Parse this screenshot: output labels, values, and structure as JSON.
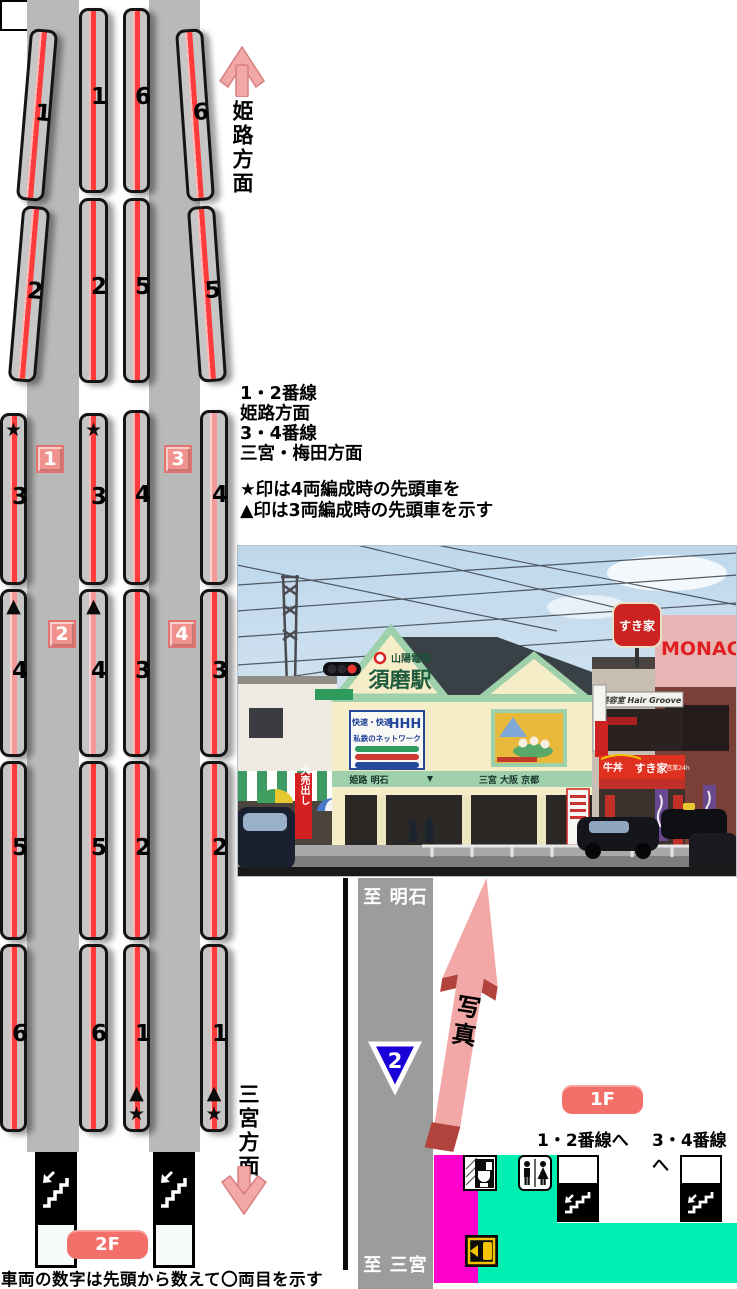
{
  "diagram": {
    "top_direction": "姫路方面",
    "bottom_direction": "三宮方面",
    "caption": "車両の数字は先頭から数えて〇両目を示す",
    "floor_upper": "2F",
    "floor_lower": "1F",
    "platform_badges": [
      "1",
      "2",
      "3",
      "4"
    ],
    "legend_lines": [
      "1・2番線",
      "姫路方面",
      "3・4番線",
      "三宮・梅田方面"
    ],
    "note_star": "★印は4両編成時の先頭車を",
    "note_triangle": "▲印は3両編成時の先頭車を示す",
    "tracks": [
      {
        "name": "track-1",
        "cars": [
          {
            "num": "1"
          },
          {
            "num": "2"
          },
          {
            "num": "3",
            "marker_top": "★"
          },
          {
            "num": "4",
            "marker_top": "▲",
            "stripe": "pink"
          },
          {
            "num": "5"
          },
          {
            "num": "6"
          }
        ]
      },
      {
        "name": "track-2",
        "cars": [
          {
            "num": "1"
          },
          {
            "num": "2"
          },
          {
            "num": "3",
            "marker_top": "★"
          },
          {
            "num": "4",
            "marker_top": "▲",
            "stripe": "pink"
          },
          {
            "num": "5"
          },
          {
            "num": "6"
          }
        ]
      },
      {
        "name": "track-3",
        "cars": [
          {
            "num": "6"
          },
          {
            "num": "5"
          },
          {
            "num": "4"
          },
          {
            "num": "3"
          },
          {
            "num": "2"
          },
          {
            "num": "1",
            "marker_bottom_triangle": "▲",
            "marker_bottom_star": "★"
          }
        ]
      },
      {
        "name": "track-4",
        "cars": [
          {
            "num": "6"
          },
          {
            "num": "5"
          },
          {
            "num": "4",
            "stripe": "pink"
          },
          {
            "num": "3"
          },
          {
            "num": "2"
          },
          {
            "num": "1",
            "marker_bottom_triangle": "▲",
            "marker_bottom_star": "★"
          }
        ]
      }
    ]
  },
  "map": {
    "road_label_top": "至 明石",
    "road_label_bottom": "至 三宮",
    "route_number": "2",
    "photo_arrow_label": "写真",
    "stairs_to_12": "1・2番線へ",
    "stairs_to_34": "3・4番線へ"
  },
  "photo": {
    "description": "山陽電車 須磨駅 駅舎の写真",
    "signs": {
      "operator": "山陽電車",
      "station_name": "須磨駅",
      "gable_panel_line1": "快速・快適",
      "gable_panel_logo": "HHH",
      "gable_panel_line2": "私鉄のネットワーク",
      "board_left": "姫路 明石",
      "board_right": "三宮 大阪 京都",
      "sukiya": "すき家",
      "beef_bowl": "牛丼",
      "open_24h": "営業24h",
      "hair_salon": "美容室 Hair Groove",
      "monaco_partial": "MONAC",
      "banner_sale": "大売出し"
    }
  },
  "colors": {
    "stripe_red": "#FF3B3B",
    "stripe_pink": "#F49999",
    "car_gray": "#C6C6C6",
    "platform_gray": "#B9B9B9",
    "badge_pink": "#F2928E",
    "floor_badge_red": "#F3706A",
    "arrow_pink": "#F3A8A8",
    "arrow_dark_red": "#B2423C",
    "map_road_gray": "#9C9C9C",
    "map_magenta": "#FF00CC",
    "map_green": "#00F0B4",
    "route_sign_blue": "#1A00D8",
    "gate_yellow": "#F5C400"
  }
}
